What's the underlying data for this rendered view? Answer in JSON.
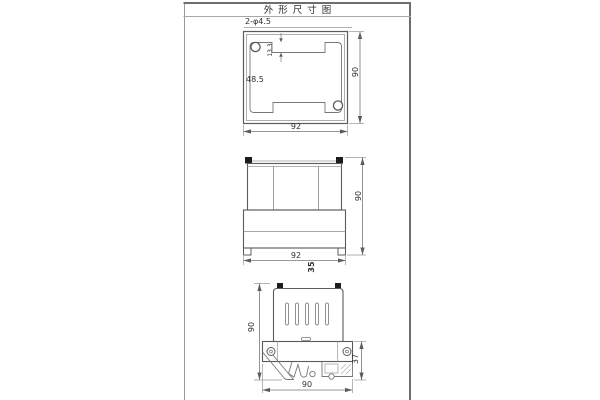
{
  "title": "外形尺寸图",
  "top_view": {
    "hole_callout": "2-φ4.5",
    "notch_depth": "13.3",
    "inner_dim": "48.5",
    "height": "90",
    "width": "92"
  },
  "front_view": {
    "height": "90",
    "width": "92",
    "depth": "35"
  },
  "side_view": {
    "height": "90",
    "rail_depth": "37",
    "width": "90"
  },
  "colors": {
    "background": "#ffffff",
    "outline": "#5b5b5b",
    "dim_line": "#777777",
    "frame_line": "#6e6e6e",
    "text": "#2e2e2e",
    "terminal_fill": "#1c1c1c"
  }
}
